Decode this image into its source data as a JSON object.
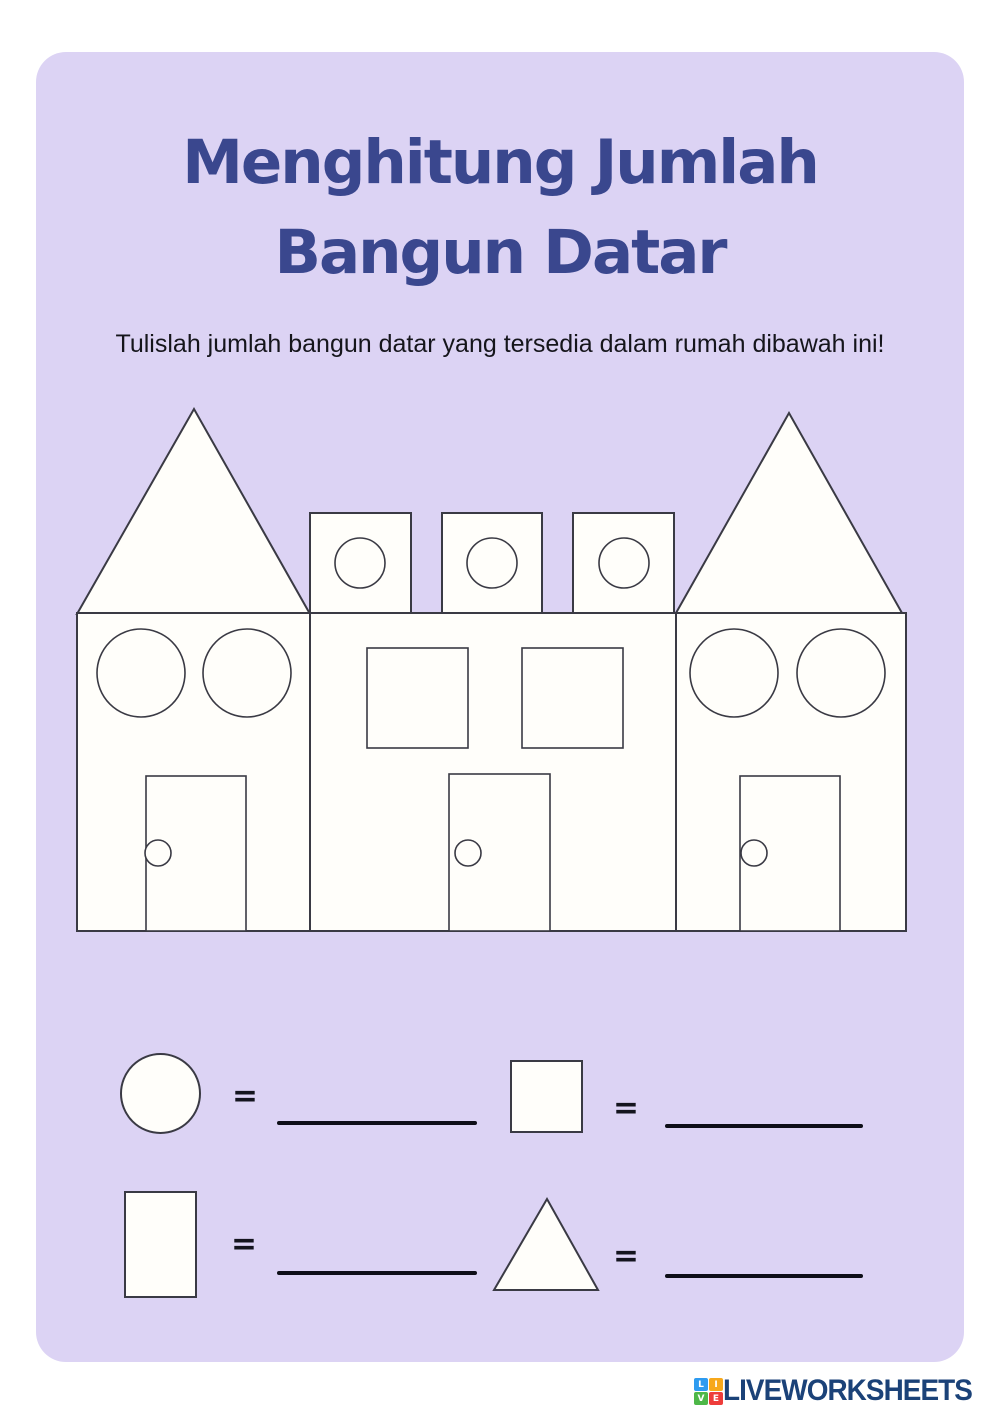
{
  "title": {
    "line1": "Menghitung Jumlah",
    "line2": "Bangun Datar",
    "color": "#3A478E"
  },
  "instruction": "Tulislah jumlah bangun datar yang tersedia dalam rumah dibawah ini!",
  "colors": {
    "page_background": "#FFFFFF",
    "card_background": "#DCD3F4",
    "shape_fill": "#FFFEFA",
    "shape_outline": "#3A3A44",
    "blank_line": "#0E0E18",
    "logo_text": "#1B4278"
  },
  "scene": {
    "description": "Row of three houses built from flat shapes",
    "houses": [
      {
        "name": "left-house",
        "shapes": [
          "triangle-roof",
          "rectangle-body",
          "circle-window",
          "circle-window",
          "rectangle-door",
          "circle-doorknob"
        ]
      },
      {
        "name": "middle-house",
        "shapes": [
          "square-battlement-with-circle",
          "square-battlement-with-circle",
          "square-battlement-with-circle",
          "rectangle-body",
          "square-window",
          "square-window",
          "rectangle-door",
          "circle-doorknob"
        ]
      },
      {
        "name": "right-house",
        "shapes": [
          "triangle-roof",
          "rectangle-body",
          "circle-window",
          "circle-window",
          "rectangle-door",
          "circle-doorknob"
        ]
      }
    ]
  },
  "answers": {
    "equals_sign": "=",
    "items": [
      {
        "shape": "circle",
        "answer": ""
      },
      {
        "shape": "square",
        "answer": ""
      },
      {
        "shape": "rectangle",
        "answer": ""
      },
      {
        "shape": "triangle",
        "answer": ""
      }
    ]
  },
  "footer": {
    "logo_text": "LIVEWORKSHEETS",
    "logo_blocks": [
      {
        "letter": "L",
        "color": "#2E9BF0"
      },
      {
        "letter": "I",
        "color": "#F7A81B"
      },
      {
        "letter": "V",
        "color": "#4DB748"
      },
      {
        "letter": "E",
        "color": "#EE3D3B"
      }
    ]
  }
}
